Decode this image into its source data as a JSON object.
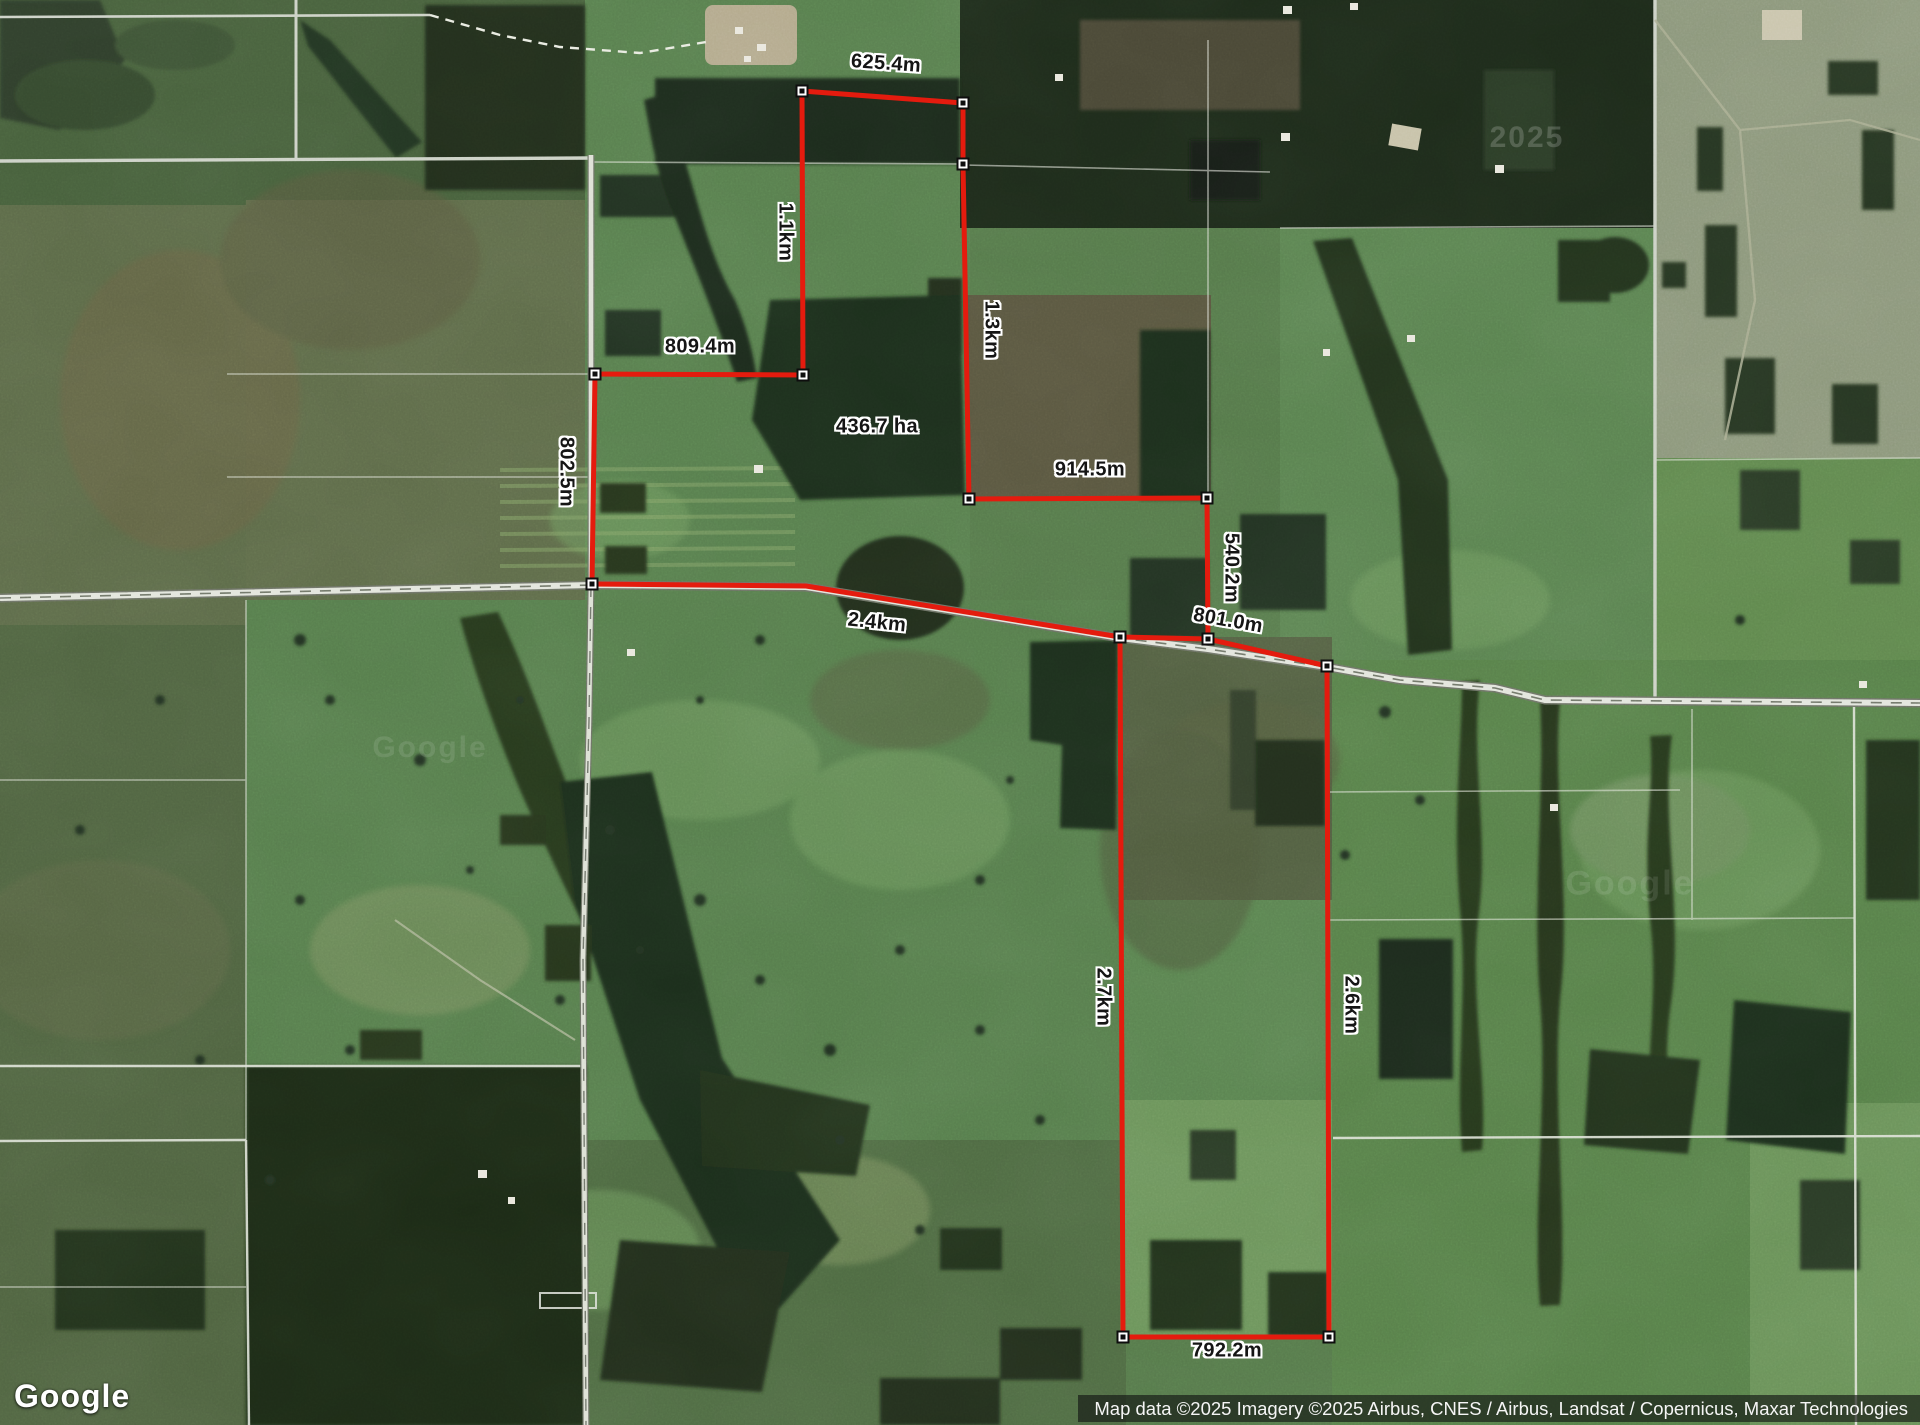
{
  "logo": {
    "text": "Google"
  },
  "attribution": {
    "text": "Map data ©2025 Imagery ©2025 Airbus, CNES / Airbus, Landsat / Copernicus, Maxar Technologies"
  },
  "watermarks": [
    {
      "text": "2025",
      "x": 1527,
      "y": 138,
      "size": 30,
      "opacity": 0.18
    },
    {
      "text": "Google",
      "x": 430,
      "y": 748,
      "size": 30,
      "opacity": 0.1
    },
    {
      "text": "Google",
      "x": 1630,
      "y": 884,
      "size": 34,
      "opacity": 0.1
    }
  ],
  "measurement": {
    "line_color": "#e41b0e",
    "area_label": {
      "text": "436.7 ha",
      "x": 877,
      "y": 427
    },
    "labels": [
      {
        "text": "625.4m",
        "x": 886,
        "y": 64,
        "rot": 4
      },
      {
        "text": "1.1km",
        "x": 785,
        "y": 232,
        "rot": 90
      },
      {
        "text": "1.3km",
        "x": 991,
        "y": 330,
        "rot": 90
      },
      {
        "text": "809.4m",
        "x": 700,
        "y": 347,
        "rot": 0
      },
      {
        "text": "914.5m",
        "x": 1090,
        "y": 470,
        "rot": 0
      },
      {
        "text": "802.5m",
        "x": 566,
        "y": 472,
        "rot": 90
      },
      {
        "text": "540.2m",
        "x": 1231,
        "y": 568,
        "rot": 90
      },
      {
        "text": "801.0m",
        "x": 1228,
        "y": 621,
        "rot": 10
      },
      {
        "text": "2.4km",
        "x": 877,
        "y": 623,
        "rot": 6
      },
      {
        "text": "2.7km",
        "x": 1103,
        "y": 997,
        "rot": 90
      },
      {
        "text": "2.6km",
        "x": 1351,
        "y": 1005,
        "rot": 90
      },
      {
        "text": "792.2m",
        "x": 1227,
        "y": 1351,
        "rot": 0
      }
    ],
    "vertices": [
      {
        "x": 802,
        "y": 91
      },
      {
        "x": 963,
        "y": 103
      },
      {
        "x": 963,
        "y": 164
      },
      {
        "x": 969,
        "y": 499
      },
      {
        "x": 1207,
        "y": 498
      },
      {
        "x": 1208,
        "y": 639
      },
      {
        "x": 1120,
        "y": 637
      },
      {
        "x": 1327,
        "y": 666
      },
      {
        "x": 1329,
        "y": 1337
      },
      {
        "x": 1123,
        "y": 1337
      },
      {
        "x": 592,
        "y": 584
      },
      {
        "x": 595,
        "y": 374
      },
      {
        "x": 803,
        "y": 375
      }
    ],
    "paths": [
      "595,374 592,584",
      "595,374 803,375",
      "803,375 802,91",
      "802,91 963,103",
      "963,103 963,164 969,499",
      "969,499 1207,498",
      "1207,498 1208,639",
      "592,584 806,586 1120,637 1208,639 1327,666",
      "1120,637 1123,1337",
      "1123,1337 1329,1337",
      "1327,666 1329,1337"
    ]
  }
}
